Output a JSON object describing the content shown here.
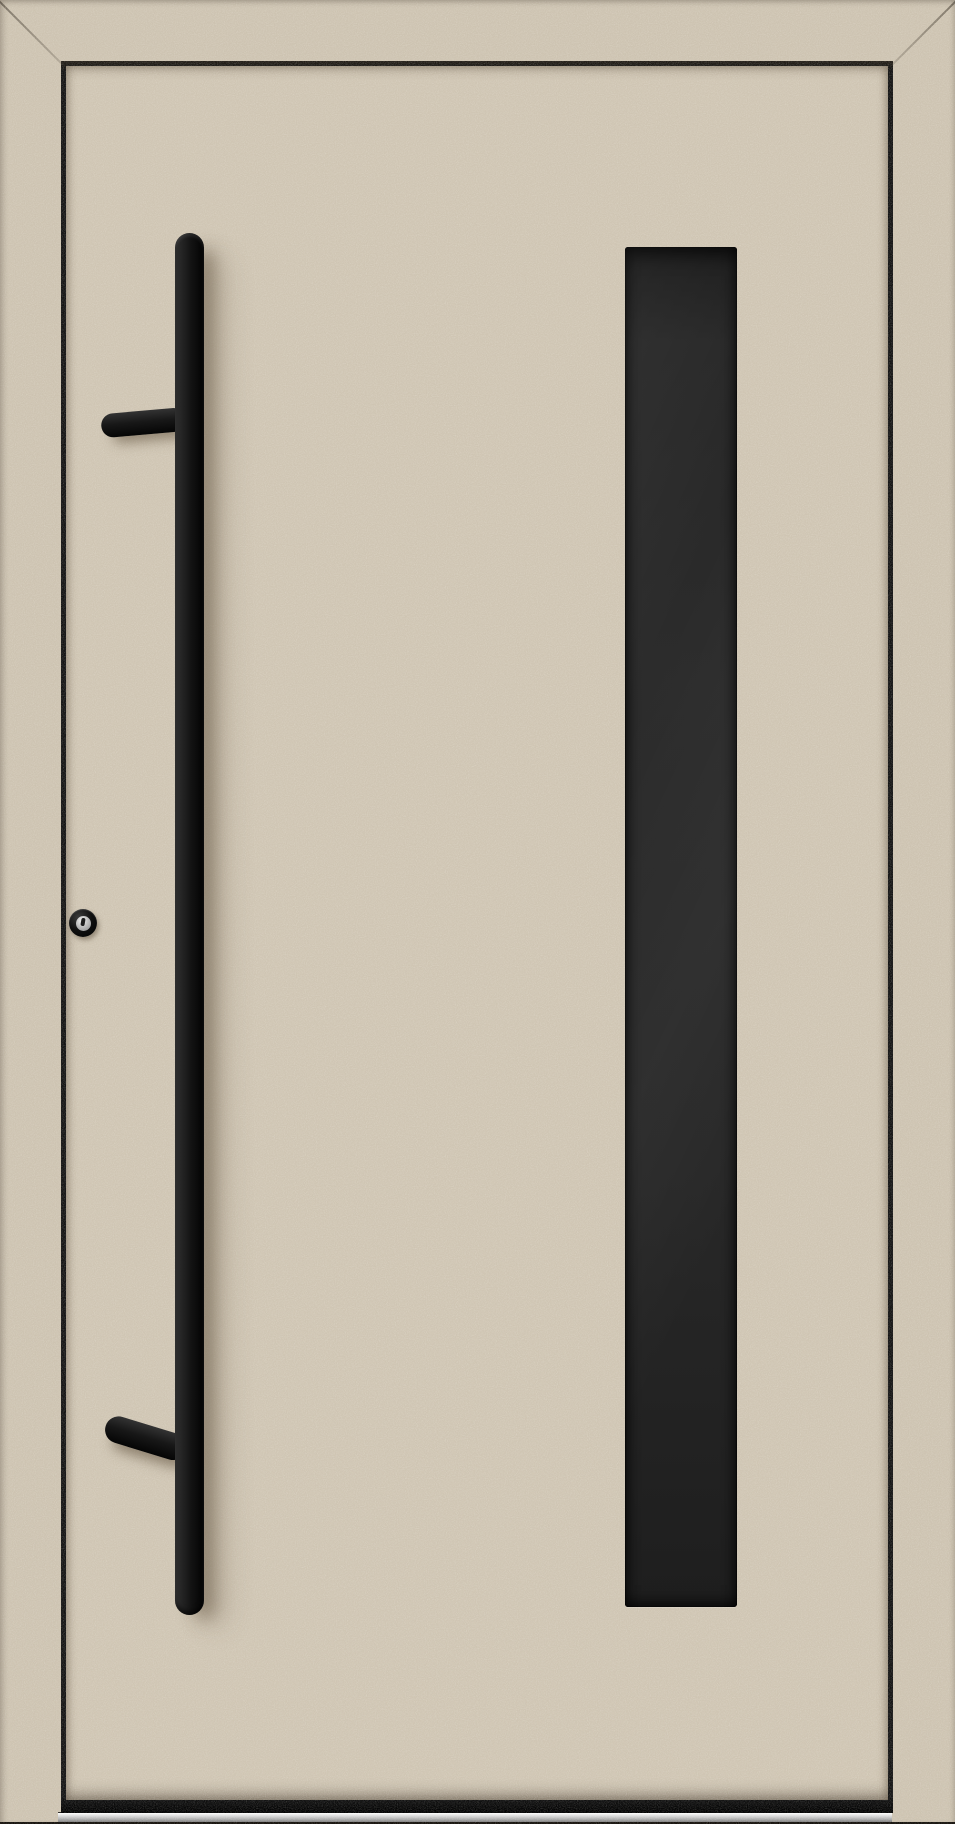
{
  "meta": {
    "description": "Product photo of a modern cream-beige aluminium front entry door with a long black vertical bar pull handle on the left, a recessed vertical dark glass panel on the right, a profile cylinder keyhole, and an aluminium threshold at the bottom."
  },
  "colors": {
    "frame-beige": "#cdc3b1",
    "door-beige": "#cfc5b3",
    "gap-dark": "#141414",
    "handle-black": "#121212",
    "glass-dark": "#272727",
    "threshold-silver": "#cccccc",
    "keyhole-silver": "#bfbfbf"
  },
  "door": {
    "frame": "beige aluminium frame with mitred top corners",
    "leaf": "flush beige door leaf",
    "handle": "black round bar pull handle with two mounting standoffs",
    "glazing": "narrow full-height dark glazing strip",
    "lock": "cylinder keyhole with silver core",
    "threshold": "brushed aluminium threshold strip"
  }
}
